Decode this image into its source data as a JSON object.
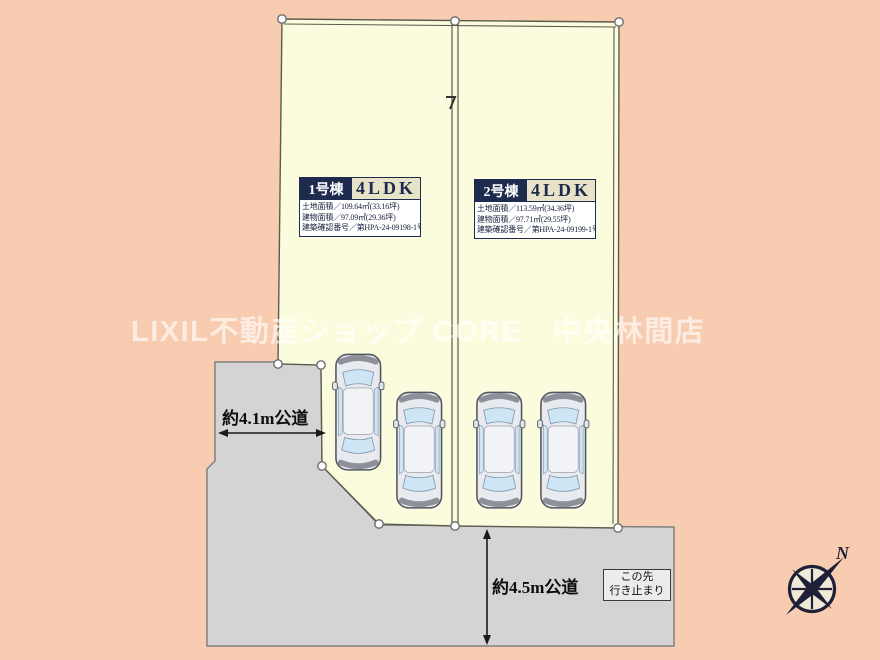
{
  "watermark": "LIXIL不動産ショップ CORE　中央林間店",
  "lots": [
    {
      "name": "1号棟",
      "plan": "4LDK",
      "land_area": "土地面積／109.64㎡(33.16坪)",
      "building_area": "建物面積／97.09㎡(29.36坪)",
      "confirmation_no": "建築確認番号／第HPA-24-09198-1号"
    },
    {
      "name": "2号棟",
      "plan": "4LDK",
      "land_area": "土地面積／113.59㎡(34.36坪)",
      "building_area": "建物面積／97.71㎡(29.55坪)",
      "confirmation_no": "建築確認番号／第HPA-24-09199-1号"
    }
  ],
  "roads": {
    "west": {
      "label": "約4.1m公道"
    },
    "south": {
      "label": "約4.5m公道"
    },
    "dead_end_sign": {
      "line1": "この先",
      "line2": "行き止まり"
    }
  },
  "compass": {
    "north": "N"
  },
  "cars": {
    "count": 4
  },
  "colors": {
    "background": "#f8ccb1",
    "lot_fill": "#fbfcde",
    "road_fill": "#d4d4d4",
    "boundary_line": "#5a5d4e",
    "navy": "#1e2b4e",
    "plan_badge_bg": "#e7e3c8",
    "marker_fill": "#ffffff",
    "watermark_color": "rgba(255,255,255,0.62)"
  }
}
